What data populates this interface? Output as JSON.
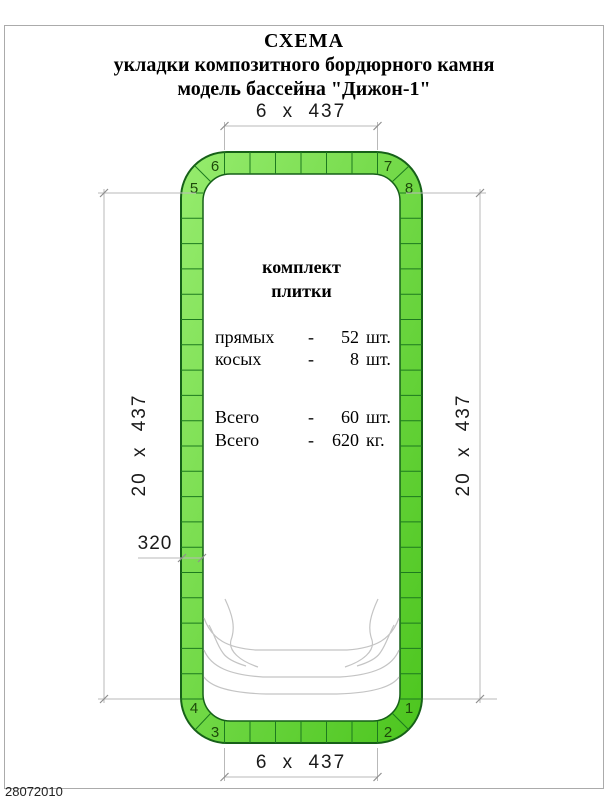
{
  "title": {
    "line1": "СХЕМА",
    "line2": "укладки композитного бордюрного камня",
    "line3": "модель бассейна  \"Дижон-1\""
  },
  "dimensions": {
    "top": "6 x 437",
    "bottom": "6 x 437",
    "left": "20 x 437",
    "right": "20 x 437",
    "tile_width": "320"
  },
  "kit": {
    "header_line1": "комплект",
    "header_line2": "плитки",
    "rows": [
      {
        "name": "прямых",
        "dash": "-",
        "value": "52",
        "unit": "шт."
      },
      {
        "name": "косых",
        "dash": "-",
        "value": "8",
        "unit": "шт."
      }
    ],
    "totals": [
      {
        "name": "Всего",
        "dash": "-",
        "value": "60",
        "unit": "шт."
      },
      {
        "name": "Всего",
        "dash": "-",
        "value": "620",
        "unit": "кг."
      }
    ]
  },
  "corner_numbers": {
    "c1": "1",
    "c2": "2",
    "c3": "3",
    "c4": "4",
    "c5": "5",
    "c6": "6",
    "c7": "7",
    "c8": "8"
  },
  "footer": {
    "date": "28072010"
  },
  "colors": {
    "tile_green_light": "#96ec6e",
    "tile_green": "#4cc51e",
    "tile_border": "#166018",
    "dim_line": "#b9b9b9"
  }
}
